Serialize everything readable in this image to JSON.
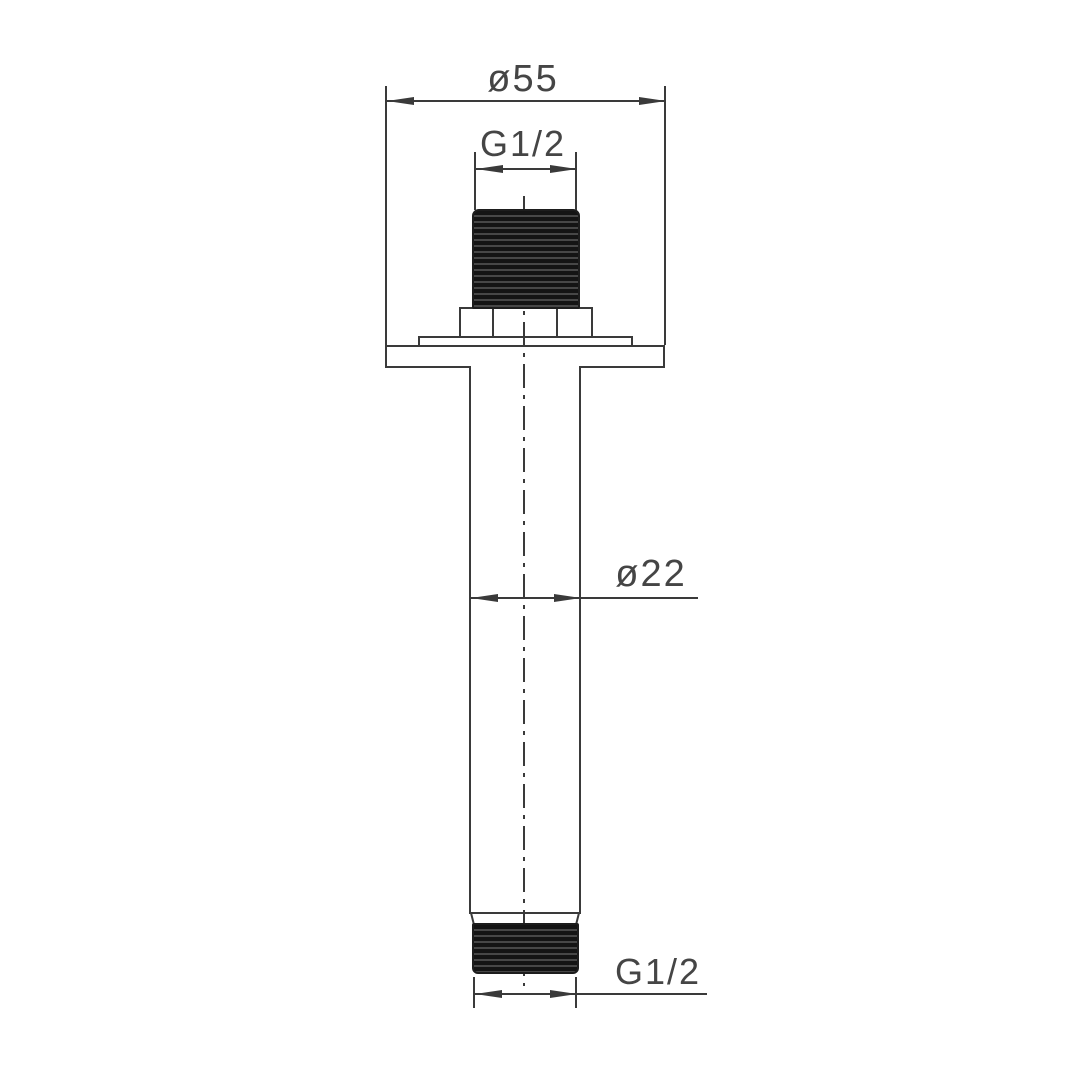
{
  "dimensions": {
    "flange_diameter": {
      "label": "ø55"
    },
    "top_thread": {
      "label": "G1/2"
    },
    "pipe_diameter": {
      "label": "ø22"
    },
    "bottom_thread": {
      "label": "G1/2"
    }
  },
  "colors": {
    "background": "#ffffff",
    "line": "#3a3a3a",
    "text": "#454545",
    "thread_fill": "#141414"
  }
}
